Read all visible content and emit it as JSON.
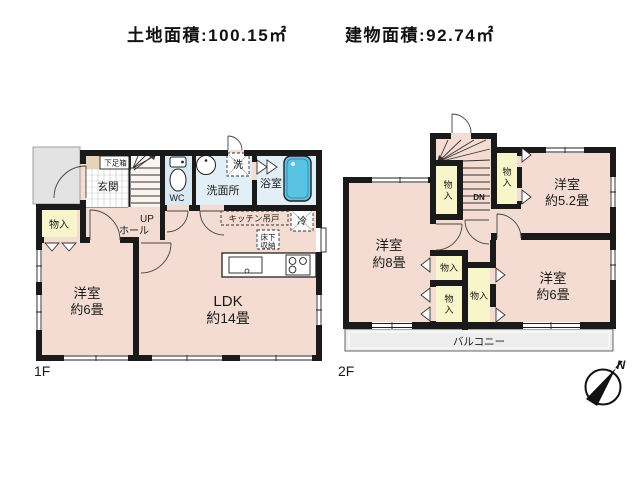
{
  "header": {
    "land_area": "土地面積:100.15㎡",
    "building_area": "建物面積:92.74㎡"
  },
  "floor1": {
    "label": "1F",
    "genkan": "玄関",
    "shoebox": "下足箱",
    "wc": "WC",
    "washroom": "洗面所",
    "washer": "洗",
    "bath": "浴室",
    "up": "UP",
    "hall": "ホール",
    "storage": "物入",
    "western6": {
      "name": "洋室",
      "size": "約6畳"
    },
    "ldk": {
      "name": "LDK",
      "size": "約14畳"
    },
    "kitchen_cabinet": "キッチン吊戸",
    "fridge": "冷",
    "underfloor_line1": "床下",
    "underfloor_line2": "収納"
  },
  "floor2": {
    "label": "2F",
    "western8": {
      "name": "洋室",
      "size": "約8畳"
    },
    "western52": {
      "name": "洋室",
      "size": "約5.2畳"
    },
    "western6": {
      "name": "洋室",
      "size": "約6畳"
    },
    "storage": "物入",
    "storage_char1": "物",
    "storage_char2": "入",
    "down": "DN",
    "balcony": "バルコニー"
  },
  "compass": {
    "north": "N"
  },
  "colors": {
    "room_pink": "#f4dcd2",
    "closet_yellow": "#f7f5c9",
    "water_blue": "#e2eff7",
    "wc_blue": "#d8e9f4",
    "tub_blue": "#58c3e3",
    "porch_gray": "#e3e3e3",
    "balcony_gray": "#ededed",
    "wall_black": "#1a1a1a"
  }
}
